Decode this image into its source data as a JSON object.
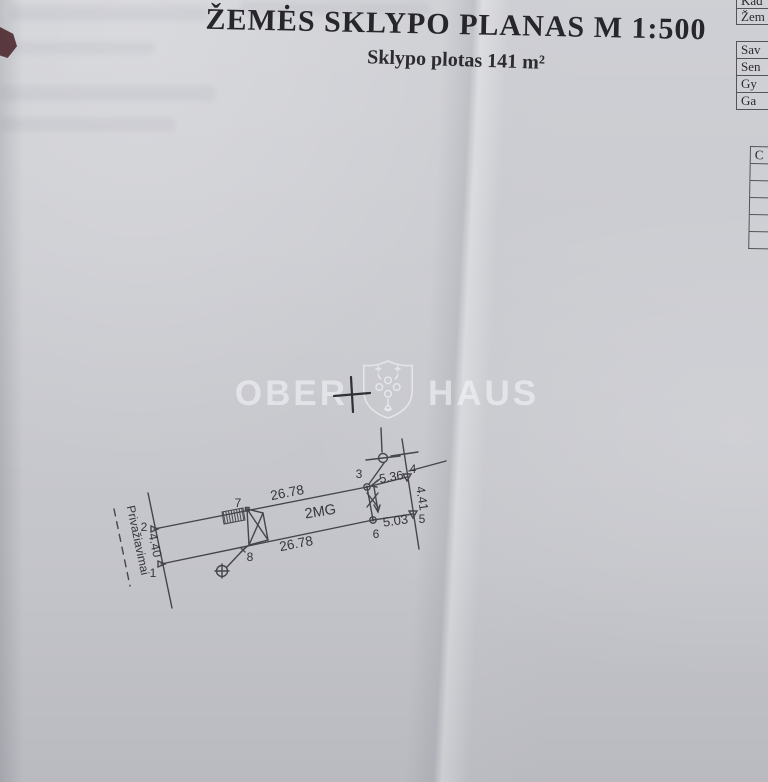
{
  "page": {
    "title": "ŽEMĖS SKLYPO PLANAS M 1:500",
    "subtitle": "Sklypo plotas 141 m²"
  },
  "watermark": {
    "left": "OBER",
    "right": "HAUS"
  },
  "side_tables": {
    "cadastral": [
      "Kad",
      "Žem"
    ],
    "location": [
      "Sav",
      "Sen",
      "Gy",
      "Ga"
    ],
    "bottom_header": "C"
  },
  "plan": {
    "dim_top": "26.78",
    "dim_bottom": "26.78",
    "dim_left": "4.40",
    "dim_ext_top": "5.36",
    "dim_ext_right": "4.41",
    "dim_ext_bottom": "5.03",
    "area_label": "2MG",
    "access_label": "Privažiavimai",
    "points": {
      "p1": "1",
      "p2": "2",
      "p3": "3",
      "p4": "4",
      "p5": "5",
      "p6": "6",
      "p7": "7",
      "p8": "8"
    }
  }
}
